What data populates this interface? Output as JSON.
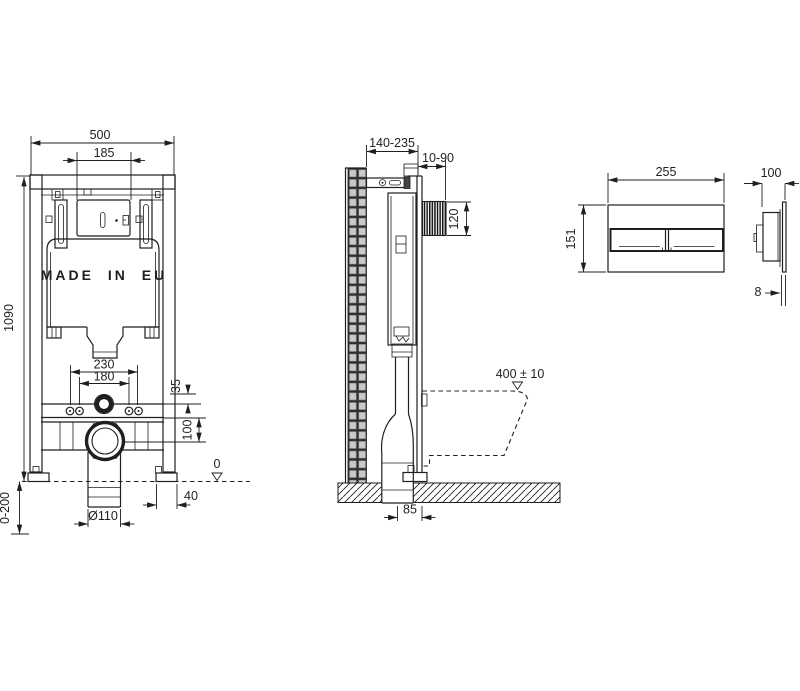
{
  "drawing_type": "wc-installation-frame-technical-drawing",
  "colors": {
    "line": "#1f1f1f",
    "tile_fill": "#c9c9c9",
    "tile_grout": "#2e2e2e",
    "background": "#ffffff"
  },
  "front_view": {
    "cistern_label": "MADE IN EU",
    "dim_width": "500",
    "dim_plate_center": "185",
    "dim_height": "1090",
    "dim_foot_adjust": "0-200",
    "dim_fixing_outer": "230",
    "dim_fixing_inner": "180",
    "dim_inlet_offset": "35",
    "dim_drain_offset": "100",
    "datum_label": "0",
    "dim_foot_depth": "40",
    "dim_drain_dia": "Ø110"
  },
  "side_view": {
    "dim_depth_range": "140-235",
    "dim_plate_range": "10-90",
    "dim_opening": "120",
    "dim_bowl_height": "400 ± 10",
    "dim_outlet": "85"
  },
  "flush_plate_front": {
    "dim_width": "255",
    "dim_height": "151"
  },
  "flush_plate_side": {
    "dim_depth": "100",
    "dim_thickness": "8"
  }
}
